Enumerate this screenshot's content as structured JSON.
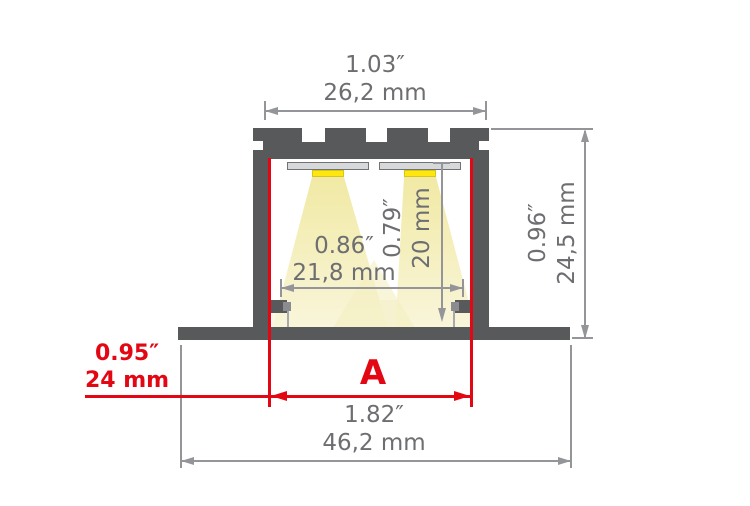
{
  "colors": {
    "profile_gray": "#58595b",
    "dimension_gray": "#939598",
    "text_gray": "#6d6e71",
    "accent_red": "#e30613",
    "led_yellow": "#ffe70e",
    "light_cone_yellow": "#f1e9a4"
  },
  "dimensions": {
    "top_width": {
      "inches": "1.03″",
      "mm": "26,2 mm"
    },
    "inner_width": {
      "inches": "0.86″",
      "mm": "21,8 mm"
    },
    "inner_height": {
      "inches": "0.79″",
      "mm": "20 mm"
    },
    "outer_height": {
      "inches": "0.96″",
      "mm": "24,5 mm"
    },
    "cutout": {
      "inches": "0.95″",
      "mm": "24 mm",
      "letter": "A"
    },
    "outer_width": {
      "inches": "1.82″",
      "mm": "46,2 mm"
    }
  }
}
